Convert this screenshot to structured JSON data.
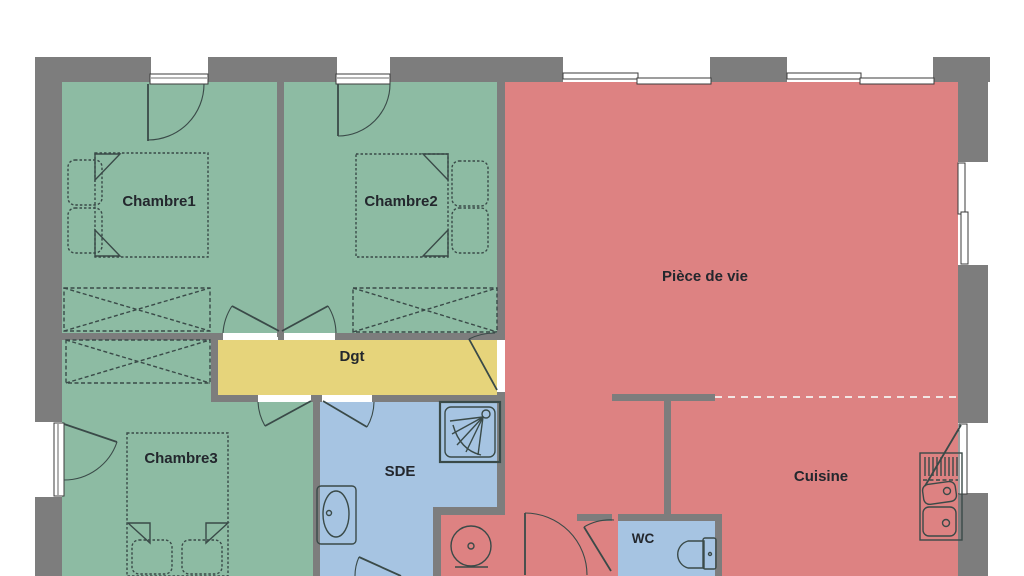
{
  "plan": {
    "labels": {
      "chambre1": "Chambre1",
      "chambre2": "Chambre2",
      "chambre3": "Chambre3",
      "piece_de_vie": "Pièce de vie",
      "cuisine": "Cuisine",
      "dgt": "Dgt",
      "sde": "SDE",
      "wc": "WC"
    }
  },
  "colors": {
    "background": "#ffffff",
    "wall_gray": "#7d7d7d",
    "bedroom_green": "#8dbba3",
    "living_red": "#dd8282",
    "hallway_yellow": "#e6d47b",
    "bathroom_blue": "#a6c4e2",
    "fixture_outline": "#3a4a48",
    "label_text": "#23272d",
    "divider_dashed": "#f2e6e4"
  }
}
